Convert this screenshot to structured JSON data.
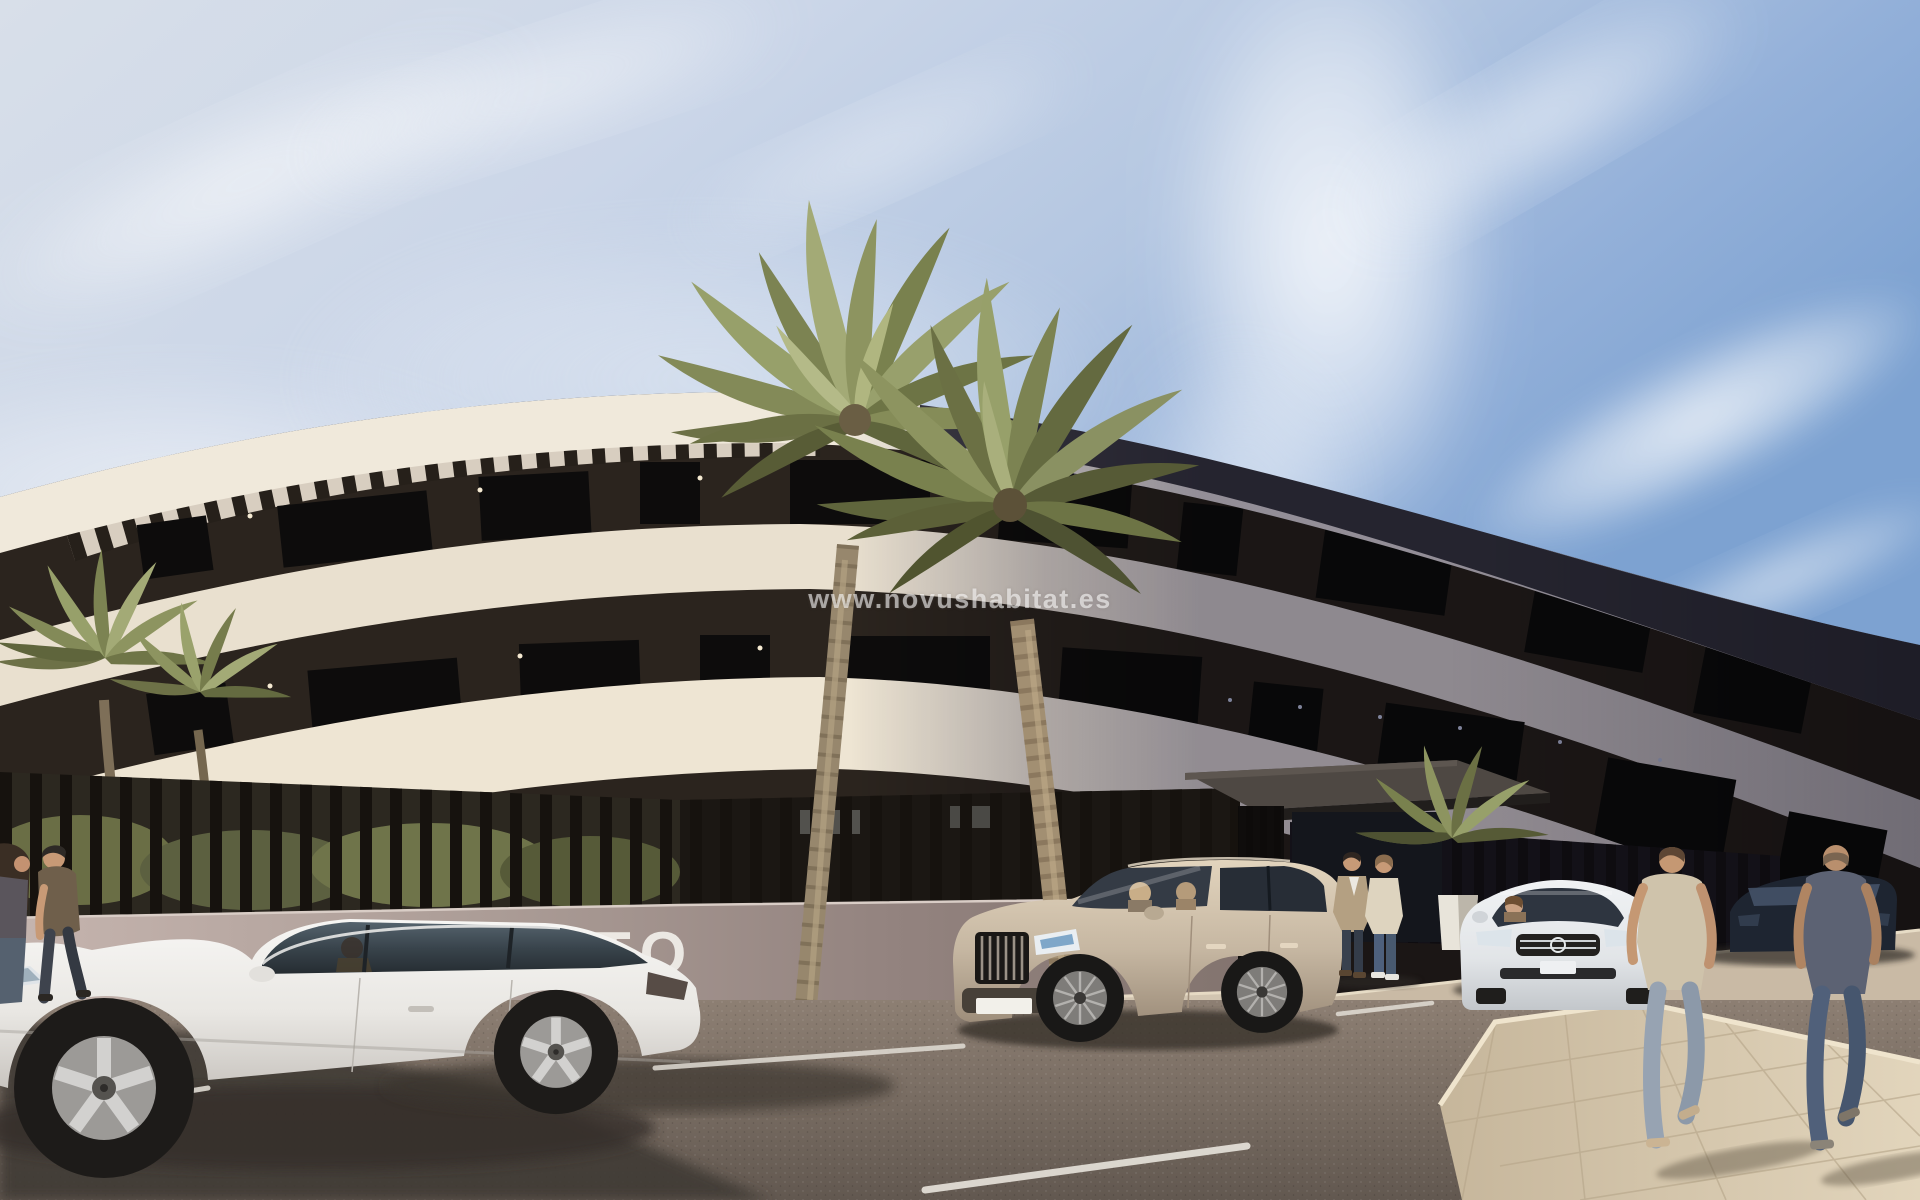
{
  "image": {
    "type": "architectural-rendering-photo",
    "description": "Exterior render of a modern curved three-storey apartment building with palm trees, parked cars and pedestrians on a sunny day",
    "width_px": 1920,
    "height_px": 1200
  },
  "watermark": {
    "text": "www.novushabitat.es",
    "color": "#ffffff",
    "opacity": 0.58,
    "position": "center"
  },
  "scene": {
    "sky": {
      "description": "pale hazy blue sky with wispy cirrus clouds, deeper blue at the upper right",
      "colors": {
        "upper_right": "#7fa3d2",
        "center": "#c3d1e6",
        "haze": "#e9edf3"
      }
    },
    "building": {
      "style": "curved white slab bands with dark recessed floors, rooftop pergola slats, right side in shadow",
      "floors_visible": 3,
      "wall_sign_text": "TO",
      "wall_sign_color": "#f0ede8",
      "colors": {
        "lit_slab": "#ece3d1",
        "recessed_band": "#2b241e",
        "shadow_side": "#74707c",
        "perimeter_wall": "#b3a29c",
        "fence_slats": "#16120e"
      },
      "features": [
        "pergola roof slats",
        "dark window bands",
        "vertical slat perimeter fence",
        "entrance canopy",
        "small facade lights"
      ]
    },
    "vehicles": [
      {
        "label": "white sedan, side view, driver inside",
        "color": "#f0efec"
      },
      {
        "label": "champagne SUV, three-quarter front view, two occupants",
        "color": "#cdbfa9"
      },
      {
        "label": "silver sedan, front view, woman driving",
        "color": "#e9ebed"
      },
      {
        "label": "dark navy car, partly hidden",
        "color": "#1e2531"
      }
    ],
    "people": [
      {
        "label": "woman walking left at far left edge",
        "clothing": "dark top, jeans"
      },
      {
        "label": "man walking left along wall",
        "clothing": "olive t-shirt, dark jeans"
      },
      {
        "label": "person standing near entrance",
        "clothing": "tan blazer, white shirt, dark jeans"
      },
      {
        "label": "person standing near entrance",
        "clothing": "cream sweater, blue jeans, white sneakers"
      },
      {
        "label": "man walking away on sidewalk",
        "clothing": "beige t-shirt, light jeans"
      },
      {
        "label": "man walking away on sidewalk",
        "clothing": "slate-blue t-shirt, blue jeans"
      }
    ],
    "vegetation": {
      "palms": [
        "two small palms at left in front of facade",
        "two tall palms at center",
        "palm bush and white planter near entrance"
      ],
      "frond_color": "#8f9461",
      "trunk_color": "#9b8a70"
    },
    "road": {
      "surface": "asphalt parking area",
      "color": "#7c7168",
      "markings": "white parking bay lines",
      "marking_color": "#e8e4dc"
    },
    "sidewalk": {
      "surface": "light stone pavers, lower right",
      "color": "#d3c5ac"
    }
  }
}
